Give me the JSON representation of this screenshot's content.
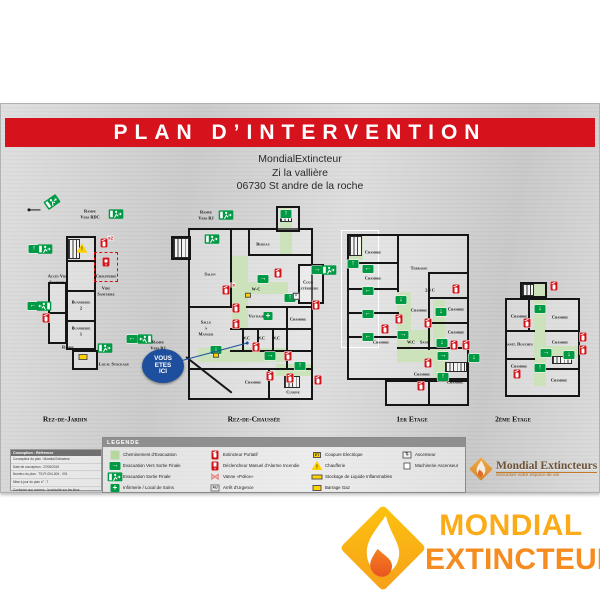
{
  "title": "PLAN D’INTERVENTION",
  "address_lines": [
    "MondialExtincteur",
    "Zi la vallière",
    "06730 St andre de la roche"
  ],
  "you_are_here": "VOUS ETES ICI",
  "colors": {
    "banner_red": "#d6131d",
    "exit_green": "#009a44",
    "path_green": "#b7d7a1",
    "alarm_red": "#cf1318",
    "safety_yellow": "#ffd200",
    "here_blue": "#1e4f9e",
    "brand_orange_light": "#fbab18",
    "brand_orange_dark": "#f68b1f"
  },
  "floors": [
    {
      "label": "Rez-de-Jardin",
      "pos": [
        28,
        93,
        152,
        214
      ],
      "walls": [
        [
          38,
          40,
          30,
          114
        ],
        [
          20,
          86,
          19,
          62
        ],
        [
          44,
          154,
          26,
          20
        ]
      ],
      "lines": [
        [
          38,
          64,
          30,
          2
        ],
        [
          38,
          94,
          30,
          2
        ],
        [
          38,
          124,
          30,
          2
        ],
        [
          20,
          116,
          19,
          2
        ]
      ],
      "redboxes": [
        [
          66,
          56,
          24,
          30
        ]
      ],
      "greens": [
        [
          40,
          43,
          12,
          20
        ]
      ],
      "stairs": [
        [
          40,
          43,
          12,
          20
        ]
      ],
      "labels": [
        [
          62,
          15,
          "Rampe"
        ],
        [
          62,
          21,
          "Vers RDC"
        ],
        [
          30,
          80,
          "Accès Vide"
        ],
        [
          30,
          86,
          "Sanitaire"
        ],
        [
          78,
          80,
          "Chaufferie"
        ],
        [
          78,
          92,
          "Vide"
        ],
        [
          78,
          98,
          "Sanitaire"
        ],
        [
          53,
          106,
          "Buanderie"
        ],
        [
          53,
          112,
          "2"
        ],
        [
          53,
          132,
          "Buanderie"
        ],
        [
          53,
          138,
          "1"
        ],
        [
          40,
          151,
          "Rampe"
        ],
        [
          86,
          168,
          "Local Stockage"
        ],
        [
          130,
          146,
          "Rampe"
        ],
        [
          130,
          152,
          "Vers RJ"
        ]
      ],
      "icons": [
        [
          24,
          6,
          "exitman",
          "right",
          -35
        ],
        [
          7,
          14,
          "dot",
          "right",
          0
        ],
        [
          88,
          18,
          "exitman",
          "right",
          0
        ],
        [
          6,
          53,
          "exit",
          "up",
          0
        ],
        [
          17,
          53,
          "exitman",
          "right",
          0
        ],
        [
          5,
          110,
          "exit",
          "left",
          0
        ],
        [
          16,
          110,
          "exitman",
          "left",
          0
        ],
        [
          18,
          122,
          "ext",
          "",
          0
        ],
        [
          76,
          47,
          "ext",
          "x2",
          0
        ],
        [
          78,
          66,
          "alarm",
          "",
          0
        ],
        [
          54,
          52,
          "warn",
          "",
          0
        ],
        [
          77,
          152,
          "exitman",
          "right",
          0
        ],
        [
          55,
          161,
          "ybox",
          "",
          0
        ],
        [
          104,
          143,
          "exit",
          "left",
          0
        ],
        [
          117,
          143,
          "exitman",
          "left",
          0
        ]
      ]
    },
    {
      "label": "Rez-de-Chaussée",
      "pos": [
        168,
        95,
        168,
        212
      ],
      "walls": [
        [
          20,
          30,
          125,
          172
        ],
        [
          108,
          8,
          24,
          26
        ],
        [
          130,
          66,
          26,
          40
        ],
        [
          3,
          38,
          20,
          24
        ]
      ],
      "lines": [
        [
          62,
          30,
          2,
          78
        ],
        [
          80,
          30,
          2,
          28
        ],
        [
          80,
          56,
          65,
          2
        ],
        [
          78,
          108,
          67,
          2
        ],
        [
          20,
          108,
          44,
          2
        ],
        [
          62,
          130,
          83,
          2
        ],
        [
          74,
          130,
          2,
          22
        ],
        [
          89,
          130,
          2,
          22
        ],
        [
          104,
          130,
          2,
          22
        ],
        [
          62,
          152,
          83,
          2
        ],
        [
          20,
          170,
          125,
          2
        ],
        [
          100,
          170,
          2,
          32
        ],
        [
          118,
          108,
          2,
          62
        ]
      ],
      "diags": [
        [
          18,
          158,
          58,
          38
        ]
      ],
      "greens": [
        [
          112,
          10,
          12,
          48
        ],
        [
          64,
          58,
          16,
          74
        ],
        [
          64,
          84,
          56,
          12
        ],
        [
          30,
          150,
          90,
          14
        ],
        [
          108,
          166,
          37,
          12
        ]
      ],
      "stairs": [
        [
          5,
          40,
          16,
          20
        ],
        [
          112,
          12,
          12,
          12
        ],
        [
          116,
          178,
          16,
          12
        ]
      ],
      "labels": [
        [
          38,
          14,
          "Rampe"
        ],
        [
          38,
          20,
          "Vers RJ"
        ],
        [
          95,
          46,
          "Bureau"
        ],
        [
          42,
          76,
          "Salon"
        ],
        [
          88,
          91,
          "W-C"
        ],
        [
          140,
          84,
          "Cour"
        ],
        [
          140,
          90,
          "Extérieure"
        ],
        [
          90,
          118,
          "Vestiaires"
        ],
        [
          38,
          124,
          "Salle"
        ],
        [
          38,
          130,
          "à"
        ],
        [
          38,
          136,
          "Manger"
        ],
        [
          78,
          140,
          "W.C"
        ],
        [
          93,
          140,
          "W.C"
        ],
        [
          108,
          140,
          "W.C"
        ],
        [
          130,
          121,
          "Chambre"
        ],
        [
          85,
          184,
          "Chambre"
        ],
        [
          125,
          194,
          "Cuisine"
        ]
      ],
      "icons": [
        [
          58,
          17,
          "exitman",
          "right",
          0
        ],
        [
          44,
          41,
          "exitman",
          "right",
          0
        ],
        [
          118,
          16,
          "exit",
          "up",
          0
        ],
        [
          110,
          75,
          "ext",
          "",
          0
        ],
        [
          95,
          81,
          "exit",
          "right",
          0
        ],
        [
          149,
          72,
          "exit",
          "right",
          0
        ],
        [
          161,
          72,
          "exitman",
          "right",
          0
        ],
        [
          122,
          100,
          "exit",
          "up",
          0
        ],
        [
          128,
          98,
          "xbox",
          "",
          0
        ],
        [
          58,
          92,
          "ext",
          "2x",
          0
        ],
        [
          80,
          97,
          "ybox-sm",
          "",
          0
        ],
        [
          68,
          110,
          "ext",
          "",
          0
        ],
        [
          68,
          126,
          "ext",
          "",
          0
        ],
        [
          100,
          118,
          "cross",
          "",
          0
        ],
        [
          48,
          152,
          "exit",
          "down",
          0
        ],
        [
          88,
          149,
          "ext",
          "",
          0
        ],
        [
          48,
          157,
          "ybox-sm",
          "",
          0
        ],
        [
          102,
          158,
          "exit",
          "right",
          0
        ],
        [
          120,
          158,
          "ext",
          "",
          0
        ],
        [
          132,
          168,
          "exit",
          "up",
          0
        ],
        [
          102,
          178,
          "ext",
          "",
          0
        ],
        [
          122,
          180,
          "ext",
          "",
          0
        ],
        [
          148,
          107,
          "ext",
          "",
          0
        ],
        [
          150,
          182,
          "ext",
          "",
          0
        ]
      ]
    },
    {
      "label": "1er Etage",
      "pos": [
        333,
        109,
        150,
        200
      ],
      "walls": [
        [
          14,
          22,
          122,
          146
        ],
        [
          52,
          168,
          84,
          26
        ]
      ],
      "whitewalls": [
        [
          8,
          18,
          38,
          118
        ]
      ],
      "lines": [
        [
          14,
          50,
          52,
          2
        ],
        [
          14,
          76,
          52,
          2
        ],
        [
          14,
          100,
          52,
          2
        ],
        [
          14,
          124,
          52,
          2
        ],
        [
          64,
          22,
          2,
          58
        ],
        [
          95,
          60,
          41,
          2
        ],
        [
          95,
          85,
          41,
          2
        ],
        [
          95,
          110,
          41,
          2
        ],
        [
          64,
          135,
          72,
          2
        ],
        [
          95,
          60,
          2,
          78
        ],
        [
          95,
          168,
          2,
          26
        ]
      ],
      "greens": [
        [
          16,
          22,
          14,
          26
        ],
        [
          64,
          80,
          14,
          58
        ],
        [
          78,
          118,
          20,
          12
        ],
        [
          100,
          88,
          12,
          50
        ],
        [
          64,
          138,
          50,
          12
        ],
        [
          100,
          150,
          12,
          20
        ]
      ],
      "stairs": [
        [
          16,
          24,
          13,
          20
        ],
        [
          112,
          150,
          22,
          10
        ]
      ],
      "labels": [
        [
          40,
          40,
          "Chambre"
        ],
        [
          86,
          56,
          "Terrasse"
        ],
        [
          40,
          66,
          "Chambre"
        ],
        [
          123,
          97,
          "Chambre"
        ],
        [
          86,
          98,
          "Chambre"
        ],
        [
          97,
          78,
          "2/4 C"
        ],
        [
          123,
          120,
          "Chambre"
        ],
        [
          48,
          130,
          "Chambre"
        ],
        [
          78,
          130,
          "W.C"
        ],
        [
          92,
          130,
          "Sanit"
        ],
        [
          89,
          162,
          "Chambre"
        ],
        [
          122,
          170,
          "Chambre"
        ]
      ],
      "icons": [
        [
          20,
          52,
          "exit",
          "up",
          0
        ],
        [
          35,
          57,
          "exit",
          "left",
          0
        ],
        [
          35,
          79,
          "exit",
          "left",
          0
        ],
        [
          35,
          102,
          "exit",
          "left",
          0
        ],
        [
          35,
          125,
          "exit",
          "left",
          0
        ],
        [
          68,
          88,
          "exit",
          "down",
          0
        ],
        [
          66,
          107,
          "ext",
          "",
          0
        ],
        [
          52,
          117,
          "ext",
          "",
          0
        ],
        [
          70,
          123,
          "exit",
          "right",
          0
        ],
        [
          123,
          77,
          "ext",
          "",
          0
        ],
        [
          108,
          100,
          "exit",
          "down",
          0
        ],
        [
          95,
          111,
          "ext",
          "",
          0
        ],
        [
          109,
          131,
          "exit",
          "down",
          0
        ],
        [
          121,
          133,
          "ext",
          "",
          0
        ],
        [
          133,
          133,
          "ext",
          "",
          0
        ],
        [
          110,
          144,
          "exit",
          "right",
          0
        ],
        [
          141,
          146,
          "exit",
          "down",
          0
        ],
        [
          95,
          151,
          "ext",
          "",
          0
        ],
        [
          110,
          165,
          "exit",
          "up",
          0
        ],
        [
          88,
          174,
          "ext",
          "",
          0
        ]
      ]
    },
    {
      "label": "2ème Etage",
      "pos": [
        470,
        135,
        125,
        176
      ],
      "walls": [
        [
          35,
          60,
          75,
          99
        ],
        [
          50,
          44,
          27,
          16
        ]
      ],
      "lines": [
        [
          35,
          92,
          30,
          2
        ],
        [
          35,
          120,
          30,
          2
        ],
        [
          75,
          92,
          35,
          2
        ],
        [
          75,
          130,
          35,
          2
        ],
        [
          58,
          60,
          2,
          32
        ]
      ],
      "greens": [
        [
          64,
          46,
          12,
          102
        ],
        [
          75,
          108,
          35,
          12
        ]
      ],
      "stairs": [
        [
          82,
          118,
          20,
          8
        ],
        [
          52,
          46,
          12,
          12
        ]
      ],
      "labels": [
        [
          49,
          78,
          "Chambre"
        ],
        [
          90,
          79,
          "Chambre"
        ],
        [
          90,
          104,
          "Chambre"
        ],
        [
          49,
          106,
          "Sanit. Douches"
        ],
        [
          49,
          128,
          "Chambre"
        ],
        [
          89,
          142,
          "Chambre"
        ]
      ],
      "icons": [
        [
          84,
          48,
          "ext",
          "",
          0
        ],
        [
          70,
          71,
          "exit",
          "down",
          0
        ],
        [
          57,
          85,
          "ext",
          "",
          0
        ],
        [
          76,
          115,
          "exit",
          "right",
          0
        ],
        [
          99,
          117,
          "exit",
          "down",
          0
        ],
        [
          70,
          130,
          "exit",
          "up",
          0
        ],
        [
          47,
          136,
          "ext",
          "",
          0
        ],
        [
          113,
          99,
          "ext",
          "",
          0
        ],
        [
          113,
          112,
          "ext",
          "",
          0
        ]
      ]
    }
  ],
  "legend": {
    "title": "LEGENDE",
    "columns": [
      [
        {
          "icon": "path",
          "label": "Cheminement d'Evacuation"
        },
        {
          "icon": "exit-right",
          "label": "Evacuation Vers Sortie Finale"
        },
        {
          "icon": "exitman",
          "label": "Evacuation Sortie Finale"
        },
        {
          "icon": "cross",
          "label": "Infirmerie / Local de Soins"
        }
      ],
      [
        {
          "icon": "ext",
          "label": "Extincteur Portatif"
        },
        {
          "icon": "alarm",
          "label": "Déclencheur Manuel d'Alarme Incendie"
        },
        {
          "icon": "valve",
          "label": "Vanne «Police»"
        },
        {
          "icon": "austop",
          "label": "Arrêt d'Urgence"
        }
      ],
      [
        {
          "icon": "etbox",
          "label": "Coupure Electrique"
        },
        {
          "icon": "warn",
          "label": "Chaufferie"
        },
        {
          "icon": "ybar",
          "label": "Stockage de Liquide Inflammables"
        },
        {
          "icon": "ybox",
          "label": "Barrage Gaz"
        }
      ],
      [
        {
          "icon": "lift",
          "label": "Ascenseur"
        },
        {
          "icon": "liftm",
          "label": "Machinerie Ascenseur"
        }
      ]
    ]
  },
  "info_box": {
    "header": "Conception : Référence",
    "lines": [
      "Concepteur du plan : Mondial Extincteur",
      "Date de conception : 27/06/2019",
      "Numéro du plan : TS-PI-004-004 - V01",
      "Mise à jour du plan n° : 7",
      "Conforme aux normes : la sécurité sur les lieux"
    ]
  },
  "plate_logo": {
    "name": "Mondial Extincteurs",
    "tagline": "Sécuriser votre espace de vie"
  },
  "brand": {
    "line1": "MONDIAL",
    "line2": "EXTINCTEUR"
  }
}
